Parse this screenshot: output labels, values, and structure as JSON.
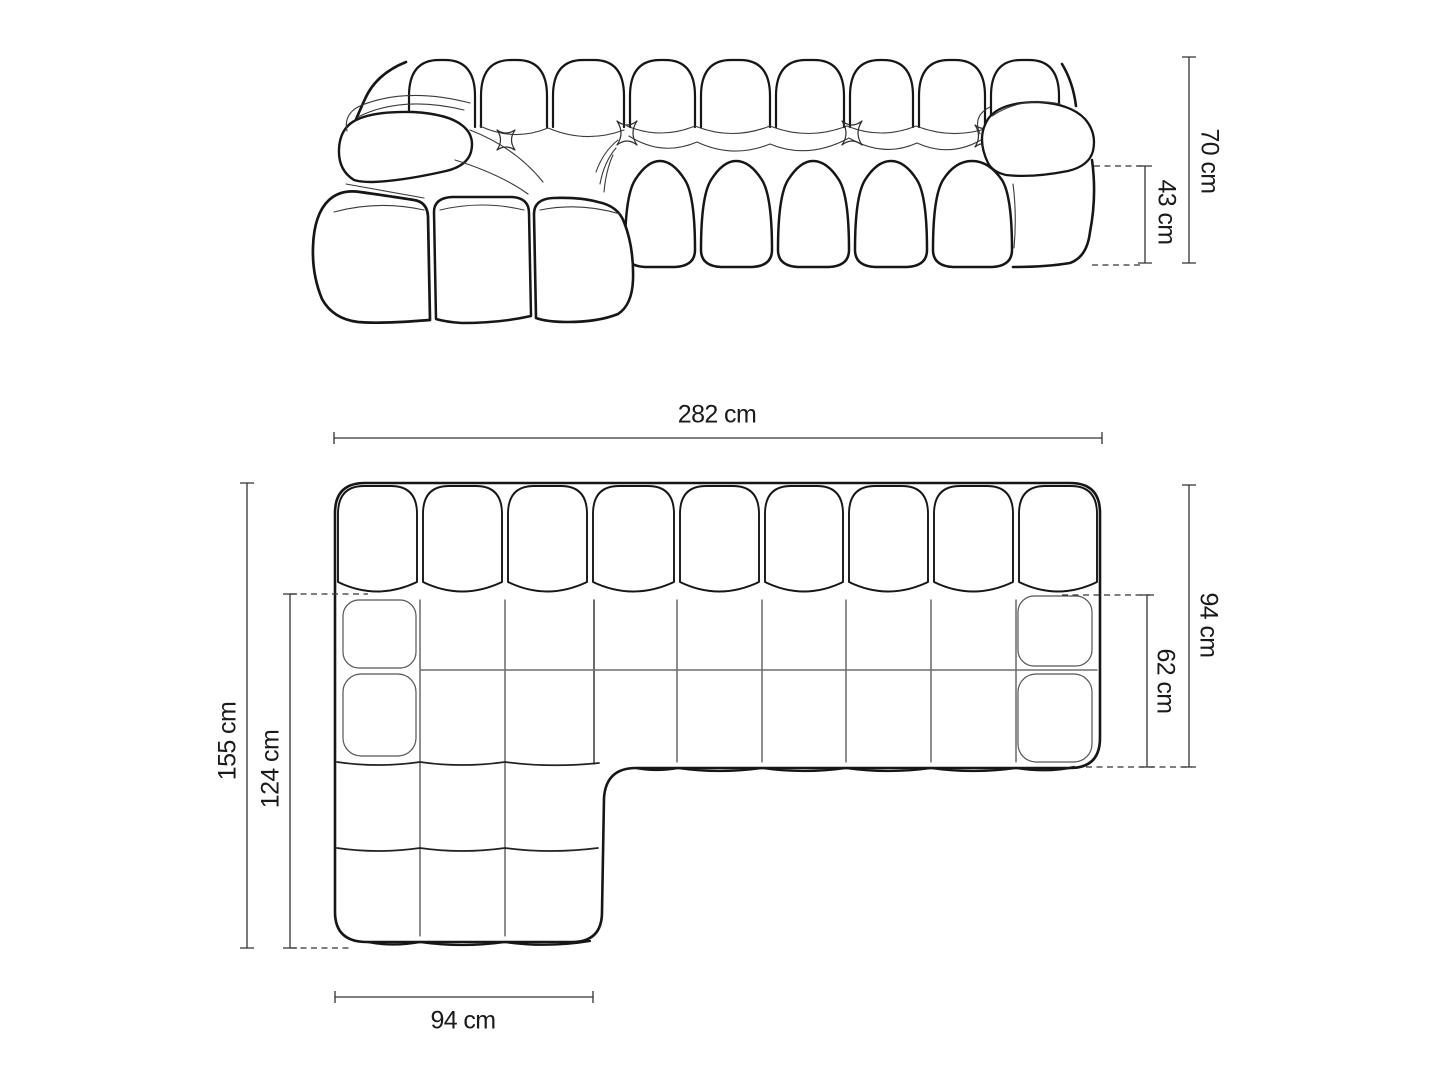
{
  "colors": {
    "background": "#ffffff",
    "sofa_outline": "#161616",
    "inner_seam": "#3a3a3a",
    "dimension_line": "#333333",
    "text": "#1a1a1a"
  },
  "views": {
    "front_elevation": {
      "dim_labels": {
        "total_height": "70 cm",
        "seat_height": "43 cm"
      }
    },
    "top_plan": {
      "dim_labels": {
        "total_width": "282 cm",
        "total_depth": "94 cm",
        "seat_depth": "62 cm",
        "total_length": "155 cm",
        "chaise_length": "124 cm",
        "chaise_width": "94 cm"
      }
    }
  }
}
